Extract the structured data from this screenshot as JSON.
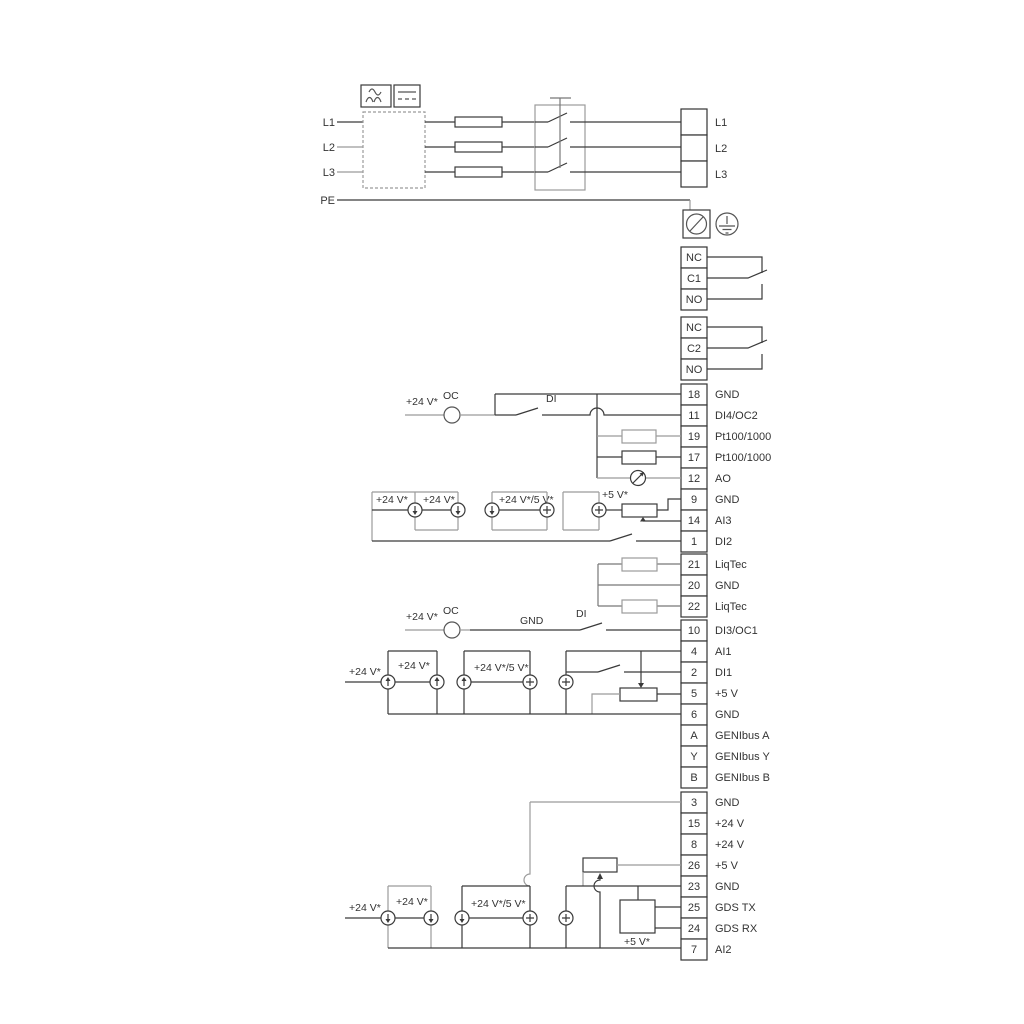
{
  "power": {
    "inputs": [
      "L1",
      "L2",
      "L3"
    ],
    "pe": "PE",
    "outputs": [
      "L1",
      "L2",
      "L3"
    ]
  },
  "relay1": {
    "t0": "NC",
    "t1": "C1",
    "t2": "NO"
  },
  "relay2": {
    "t0": "NC",
    "t1": "C2",
    "t2": "NO"
  },
  "io": {
    "s1": [
      {
        "n": "18",
        "l": "GND"
      },
      {
        "n": "11",
        "l": "DI4/OC2"
      },
      {
        "n": "19",
        "l": "Pt100/1000"
      },
      {
        "n": "17",
        "l": "Pt100/1000"
      },
      {
        "n": "12",
        "l": "AO"
      },
      {
        "n": "9",
        "l": "GND"
      },
      {
        "n": "14",
        "l": "AI3"
      },
      {
        "n": "1",
        "l": "DI2"
      }
    ],
    "s2": [
      {
        "n": "21",
        "l": "LiqTec"
      },
      {
        "n": "20",
        "l": "GND"
      },
      {
        "n": "22",
        "l": "LiqTec"
      }
    ],
    "s3": [
      {
        "n": "10",
        "l": "DI3/OC1"
      },
      {
        "n": "4",
        "l": "AI1"
      },
      {
        "n": "2",
        "l": "DI1"
      },
      {
        "n": "5",
        "l": "+5 V"
      },
      {
        "n": "6",
        "l": "GND"
      },
      {
        "n": "A",
        "l": "GENIbus A"
      },
      {
        "n": "Y",
        "l": "GENIbus Y"
      },
      {
        "n": "B",
        "l": "GENIbus B"
      }
    ],
    "s4": [
      {
        "n": "3",
        "l": "GND"
      },
      {
        "n": "15",
        "l": "+24 V"
      },
      {
        "n": "8",
        "l": "+24 V"
      },
      {
        "n": "26",
        "l": "+5 V"
      },
      {
        "n": "23",
        "l": "GND"
      },
      {
        "n": "25",
        "l": "GDS TX"
      },
      {
        "n": "24",
        "l": "GDS RX"
      },
      {
        "n": "7",
        "l": "AI2"
      }
    ]
  },
  "ann": {
    "v24": "+24 V*",
    "v245": "+24 V*/5 V*",
    "v5": "+5 V*",
    "oc": "OC",
    "di": "DI",
    "gnd": "GND"
  },
  "colors": {
    "line": "#3a3a3a",
    "line_gray": "#9b9b9b"
  }
}
